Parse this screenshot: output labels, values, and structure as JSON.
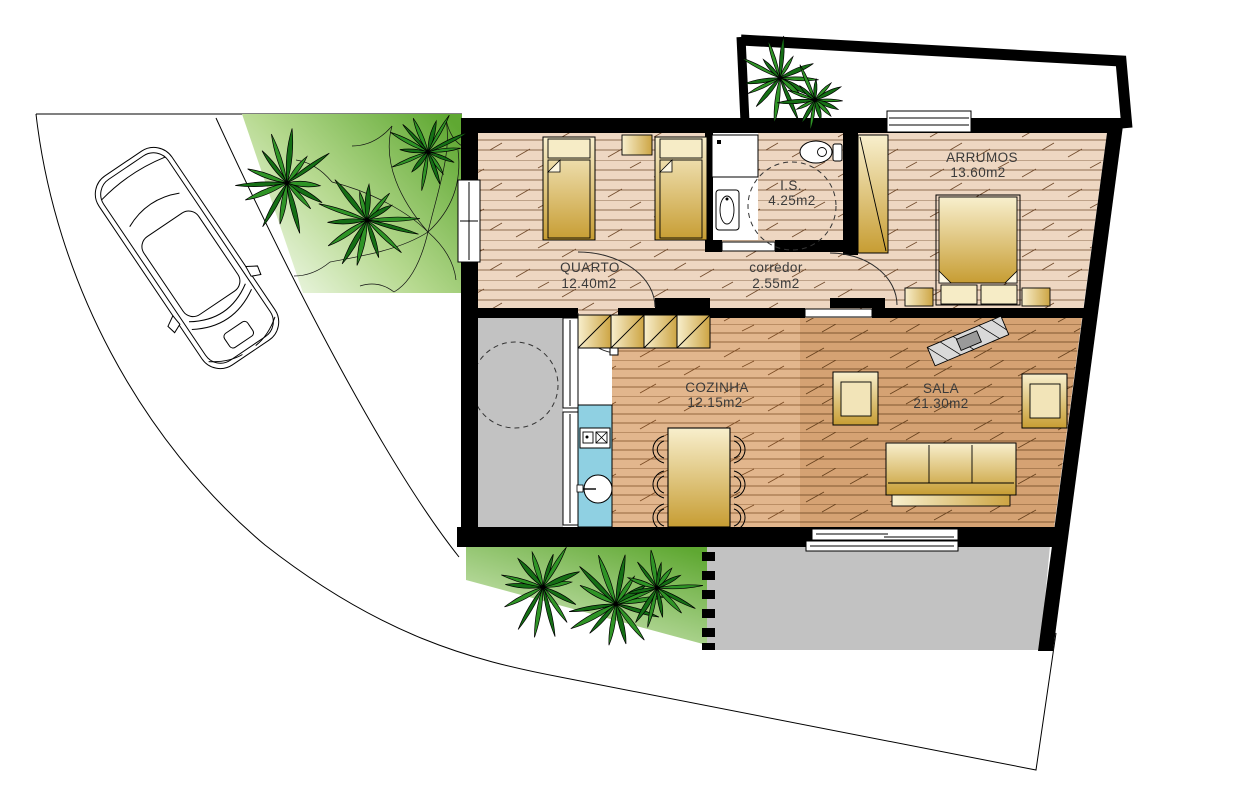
{
  "rooms": [
    {
      "id": "quarto",
      "label": "QUARTO",
      "area": "12.40m2"
    },
    {
      "id": "is",
      "label": "I.S.",
      "area": "4.25m2"
    },
    {
      "id": "corredor",
      "label": "corredor",
      "area": "2.55m2"
    },
    {
      "id": "arrumos",
      "label": "ARRUMOS",
      "area": "13.60m2"
    },
    {
      "id": "cozinha",
      "label": "COZINHA",
      "area": "12.15m2"
    },
    {
      "id": "sala",
      "label": "SALA",
      "area": "21.30m2"
    }
  ],
  "colors": {
    "wall": "#000000",
    "floor_bedrooms": "#eed7c2",
    "floor_kitchen": "#e2b68d",
    "floor_sala": "#d5a273",
    "furniture_gold": "#c79d33",
    "garden_green_dark": "#5fa832",
    "garden_green_light": "#eef7e2",
    "terrace_gray": "#c2c2c2",
    "counter_blue": "#8fd0e2"
  },
  "decor": {
    "palms": [
      {
        "x": 287,
        "y": 183,
        "s": 46,
        "seed": 3
      },
      {
        "x": 367,
        "y": 220,
        "s": 44,
        "seed": 7
      },
      {
        "x": 428,
        "y": 152,
        "s": 36,
        "seed": 11
      },
      {
        "x": 780,
        "y": 78,
        "s": 38,
        "seed": 5
      },
      {
        "x": 815,
        "y": 100,
        "s": 31,
        "seed": 9
      },
      {
        "x": 543,
        "y": 587,
        "s": 43,
        "seed": 13
      },
      {
        "x": 616,
        "y": 604,
        "s": 45,
        "seed": 17
      },
      {
        "x": 657,
        "y": 588,
        "s": 38,
        "seed": 21
      }
    ]
  }
}
